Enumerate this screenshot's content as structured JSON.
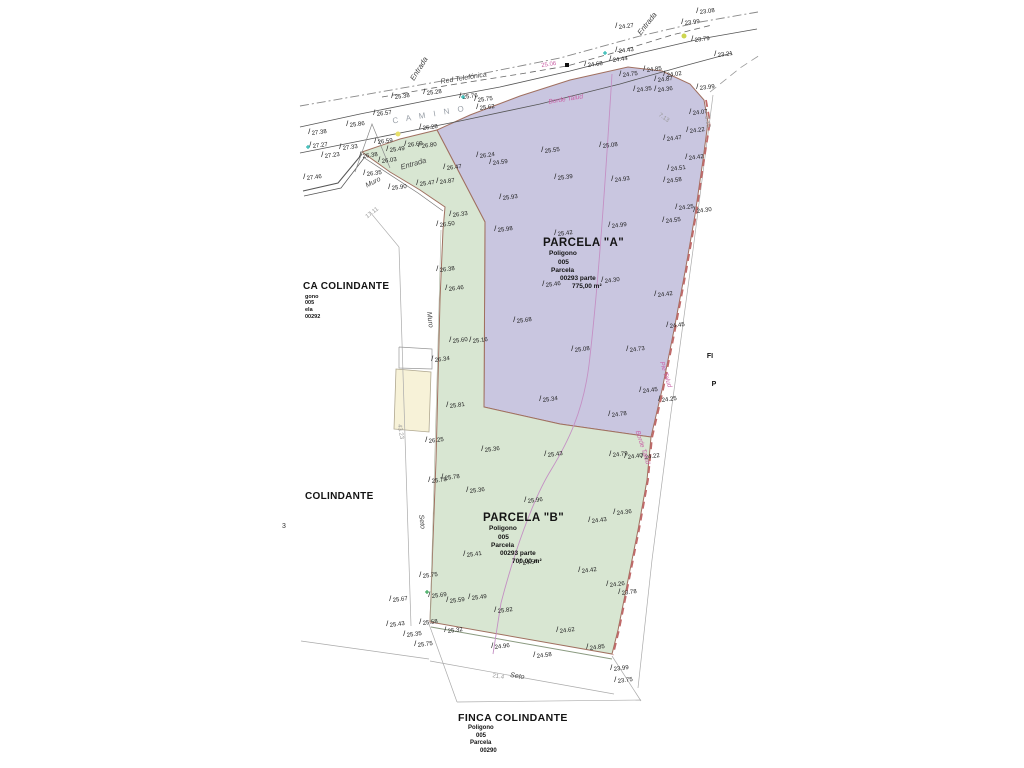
{
  "canvas": {
    "w": 1024,
    "h": 768,
    "bg": "#ffffff"
  },
  "colors": {
    "parcel_a_fill": "#c9c6e0",
    "parcel_b_fill": "#d8e6d2",
    "building_fill": "#f7f2d8",
    "parcel_stroke": "#a07060",
    "boundary_dash": "#c06a6a",
    "contour": "#c490c4",
    "pink_label": "#c95fa5",
    "dim_gray": "#aaaaaa",
    "road": "#555555"
  },
  "blocks": {
    "a": {
      "title": "PARCELA \"A\"",
      "lines": [
        "Poligono",
        "005",
        "Parcela",
        "00293 parte",
        "775,00 m²"
      ]
    },
    "b": {
      "title": "PARCELA \"B\"",
      "lines": [
        "Poligono",
        "005",
        "Parcela",
        "00293 parte",
        "700,00 m²"
      ]
    },
    "finca_bottom": {
      "title": "FINCA COLINDANTE",
      "lines": [
        "Poligono",
        "005",
        "Parcela",
        "00290"
      ]
    },
    "finca_left": {
      "title": "CA COLINDANTE",
      "lines": [
        "gono",
        "005",
        "ela",
        "00292"
      ]
    },
    "colindante": {
      "title": "COLINDANTE"
    }
  },
  "misc": {
    "left_digit": "3"
  },
  "parcels": [
    {
      "id": "parcel-a",
      "fill": "#c9c6e0",
      "stroke": "#a07060",
      "w": 1,
      "points": [
        [
          437,
          130
        ],
        [
          470,
          115
        ],
        [
          520,
          96
        ],
        [
          570,
          80
        ],
        [
          628,
          67
        ],
        [
          662,
          71
        ],
        [
          690,
          84
        ],
        [
          704,
          100
        ],
        [
          708,
          122
        ],
        [
          703,
          160
        ],
        [
          695,
          215
        ],
        [
          685,
          272
        ],
        [
          674,
          330
        ],
        [
          662,
          390
        ],
        [
          651,
          437
        ],
        [
          560,
          424
        ],
        [
          484,
          407
        ],
        [
          485,
          222
        ]
      ]
    },
    {
      "id": "parcel-b",
      "fill": "#d8e6d2",
      "stroke": "#a07060",
      "w": 1,
      "points": [
        [
          362,
          152
        ],
        [
          400,
          139
        ],
        [
          437,
          130
        ],
        [
          485,
          222
        ],
        [
          484,
          407
        ],
        [
          560,
          424
        ],
        [
          651,
          437
        ],
        [
          647,
          480
        ],
        [
          638,
          530
        ],
        [
          628,
          580
        ],
        [
          618,
          630
        ],
        [
          612,
          654
        ],
        [
          430,
          622
        ],
        [
          433,
          540
        ],
        [
          436,
          460
        ],
        [
          438,
          380
        ],
        [
          440,
          300
        ],
        [
          443,
          230
        ],
        [
          445,
          207
        ],
        [
          420,
          190
        ],
        [
          390,
          172
        ]
      ]
    },
    {
      "id": "building",
      "fill": "#f7f2d8",
      "stroke": "#b0a890",
      "w": 0.8,
      "points": [
        [
          396,
          369
        ],
        [
          431,
          372
        ],
        [
          429,
          432
        ],
        [
          394,
          429
        ]
      ]
    }
  ],
  "lines": [
    {
      "p": [
        [
          300,
          106
        ],
        [
          380,
          92
        ],
        [
          470,
          76
        ],
        [
          560,
          58
        ],
        [
          640,
          36
        ],
        [
          700,
          22
        ],
        [
          758,
          12
        ]
      ],
      "c": "#888",
      "w": 0.9,
      "d": "9 3 2 3"
    },
    {
      "p": [
        [
          382,
          97
        ],
        [
          450,
          85
        ],
        [
          520,
          74
        ],
        [
          567,
          66
        ],
        [
          620,
          51
        ],
        [
          672,
          35
        ],
        [
          712,
          25
        ]
      ],
      "c": "#666",
      "w": 0.8,
      "d": "6 4"
    },
    {
      "p": [
        [
          300,
          127
        ],
        [
          360,
          114
        ],
        [
          430,
          100
        ],
        [
          500,
          87
        ],
        [
          570,
          71
        ],
        [
          640,
          53
        ],
        [
          700,
          39
        ],
        [
          757,
          29
        ]
      ],
      "c": "#555",
      "w": 0.8
    },
    {
      "p": [
        [
          300,
          153
        ],
        [
          380,
          137
        ],
        [
          460,
          121
        ],
        [
          540,
          104
        ],
        [
          620,
          84
        ],
        [
          680,
          67
        ],
        [
          732,
          53
        ]
      ],
      "c": "#555",
      "w": 0.8
    },
    {
      "p": [
        [
          303,
          191
        ],
        [
          338,
          183
        ],
        [
          362,
          154
        ]
      ],
      "c": "#555",
      "w": 1
    },
    {
      "p": [
        [
          304,
          196
        ],
        [
          341,
          188
        ],
        [
          364,
          158
        ]
      ],
      "c": "#555",
      "w": 0.7
    },
    {
      "p": [
        [
          355,
          172
        ],
        [
          372,
          124
        ],
        [
          390,
          168
        ]
      ],
      "c": "#888",
      "w": 0.7
    },
    {
      "p": [
        [
          363,
          157
        ],
        [
          418,
          193
        ],
        [
          443,
          211
        ]
      ],
      "c": "#777",
      "w": 0.7
    },
    {
      "p": [
        [
          441,
          230
        ],
        [
          437,
          380
        ],
        [
          433,
          520
        ],
        [
          430,
          620
        ]
      ],
      "c": "#aab5a0",
      "w": 0.6
    },
    {
      "p": [
        [
          399,
          247
        ],
        [
          411,
          626
        ]
      ],
      "c": "#aaa",
      "w": 0.7
    },
    {
      "p": [
        [
          399,
          247
        ],
        [
          370,
          212
        ]
      ],
      "c": "#aaa",
      "w": 0.6
    },
    {
      "p": [
        [
          301,
          641
        ],
        [
          429,
          659
        ]
      ],
      "c": "#aaa",
      "w": 0.7
    },
    {
      "p": [
        [
          430,
          661
        ],
        [
          614,
          694
        ]
      ],
      "c": "#aaa",
      "w": 0.7
    },
    {
      "p": [
        [
          429,
          624
        ],
        [
          457,
          702
        ]
      ],
      "c": "#aaa",
      "w": 0.7
    },
    {
      "p": [
        [
          612,
          656
        ],
        [
          641,
          701
        ]
      ],
      "c": "#aaa",
      "w": 0.7
    },
    {
      "p": [
        [
          457,
          702
        ],
        [
          641,
          700
        ]
      ],
      "c": "#aaa",
      "w": 0.7
    },
    {
      "p": [
        [
          713,
          95
        ],
        [
          693,
          250
        ],
        [
          670,
          420
        ],
        [
          652,
          560
        ],
        [
          638,
          688
        ]
      ],
      "c": "#aaa",
      "w": 0.7
    },
    {
      "p": [
        [
          706,
          100
        ],
        [
          710,
          122
        ],
        [
          704,
          160
        ],
        [
          696,
          215
        ],
        [
          686,
          272
        ],
        [
          675,
          330
        ],
        [
          663,
          390
        ],
        [
          652,
          438
        ],
        [
          648,
          480
        ],
        [
          639,
          530
        ],
        [
          629,
          580
        ],
        [
          619,
          630
        ],
        [
          613,
          655
        ]
      ],
      "c": "#c06a6a",
      "w": 1.8,
      "d": "7 5"
    },
    {
      "p": [
        [
          710,
          92
        ],
        [
          740,
          68
        ],
        [
          760,
          55
        ]
      ],
      "c": "#999",
      "w": 0.8,
      "d": "8 5"
    },
    {
      "p": [
        [
          399,
          347
        ],
        [
          432,
          349
        ],
        [
          432,
          369
        ],
        [
          399,
          368
        ],
        [
          399,
          347
        ]
      ],
      "c": "#999",
      "w": 0.7
    },
    {
      "p": [
        [
          431,
          627
        ],
        [
          612,
          659
        ]
      ],
      "c": "#8a9a80",
      "w": 1
    }
  ],
  "curves": [
    {
      "d": "M612,74 C606,170 599,280 589,365 C583,412 568,442 551,470 C533,499 514,553 501,603 L493,654",
      "c": "#c490c4",
      "w": 0.9
    }
  ],
  "rotated_labels": [
    {
      "t": "Entrada",
      "x": 421,
      "y": 70,
      "r": -58,
      "s": 7.5,
      "i": 1
    },
    {
      "t": "Entrada",
      "x": 649,
      "y": 25,
      "r": -52,
      "s": 7.5,
      "i": 1
    },
    {
      "t": "Entrada",
      "x": 414,
      "y": 166,
      "r": -16,
      "s": 7.5,
      "i": 1
    },
    {
      "t": "Red Telefónica",
      "x": 464,
      "y": 80,
      "r": -9,
      "s": 7,
      "i": 1
    },
    {
      "t": "C A M I N O",
      "x": 430,
      "y": 117,
      "r": -10,
      "s": 8,
      "c": "#9aa0a8",
      "sp": 3
    },
    {
      "t": "Muro",
      "x": 374,
      "y": 184,
      "r": -27,
      "s": 7,
      "i": 1
    },
    {
      "t": "Muro",
      "x": 428,
      "y": 320,
      "r": 83,
      "s": 7,
      "i": 1
    },
    {
      "t": "Seto",
      "x": 420,
      "y": 522,
      "r": 83,
      "s": 7,
      "i": 1
    },
    {
      "t": "Seto",
      "x": 517,
      "y": 678,
      "r": 9,
      "s": 7,
      "i": 1
    },
    {
      "t": "17.11",
      "x": 373,
      "y": 214,
      "r": -38,
      "s": 6,
      "c": "#999"
    },
    {
      "t": "43.23",
      "x": 399,
      "y": 432,
      "r": 80,
      "s": 6,
      "c": "#999"
    },
    {
      "t": "7.13",
      "x": 663,
      "y": 119,
      "r": 35,
      "s": 6,
      "c": "#999"
    },
    {
      "t": "3.18",
      "x": 706,
      "y": 122,
      "r": 80,
      "s": 6,
      "c": "#999"
    },
    {
      "t": "21.4",
      "x": 498,
      "y": 678,
      "r": 9,
      "s": 6,
      "c": "#999"
    },
    {
      "t": "25.06",
      "x": 549,
      "y": 66,
      "r": -9,
      "s": 6,
      "c": "#c95fa5"
    },
    {
      "t": "Borde Talud",
      "x": 566,
      "y": 101,
      "r": -9,
      "s": 6.5,
      "c": "#c95fa5",
      "i": 1
    },
    {
      "t": "Pie Talud",
      "x": 664,
      "y": 375,
      "r": 72,
      "s": 6.5,
      "c": "#c95fa5",
      "i": 1
    },
    {
      "t": "Borde Talud",
      "x": 641,
      "y": 448,
      "r": 72,
      "s": 6.5,
      "c": "#c95fa5",
      "i": 1
    },
    {
      "t": "FI",
      "x": 710,
      "y": 358,
      "r": 0,
      "s": 7,
      "b": 1,
      "c": "#111"
    },
    {
      "t": "P",
      "x": 714,
      "y": 386,
      "r": 0,
      "s": 7,
      "b": 1,
      "c": "#111"
    }
  ],
  "elevations": [
    [
      "27.38",
      312,
      135
    ],
    [
      "27.27",
      313,
      148
    ],
    [
      "27.23",
      325,
      158
    ],
    [
      "27.46",
      307,
      180
    ],
    [
      "27.33",
      343,
      150
    ],
    [
      "26.35",
      367,
      176
    ],
    [
      "26.38",
      363,
      158
    ],
    [
      "26.59",
      378,
      144
    ],
    [
      "25.86",
      350,
      127
    ],
    [
      "26.57",
      377,
      116
    ],
    [
      "25.38",
      395,
      99
    ],
    [
      "25.28",
      427,
      95
    ],
    [
      "26.28",
      423,
      130
    ],
    [
      "25.76",
      463,
      99
    ],
    [
      "25.75",
      478,
      102
    ],
    [
      "25.62",
      480,
      110
    ],
    [
      "25.90",
      392,
      190
    ],
    [
      "26.69",
      408,
      147
    ],
    [
      "26.80",
      422,
      148
    ],
    [
      "25.49",
      390,
      152
    ],
    [
      "26.47",
      447,
      170
    ],
    [
      "26.03",
      382,
      163
    ],
    [
      "25.47",
      420,
      186
    ],
    [
      "24.87",
      440,
      184
    ],
    [
      "24.27",
      619,
      29
    ],
    [
      "23.99",
      685,
      25
    ],
    [
      "23.08",
      700,
      14
    ],
    [
      "23.79",
      695,
      42
    ],
    [
      "23.21",
      718,
      57
    ],
    [
      "24.43",
      619,
      53
    ],
    [
      "24.44",
      613,
      62
    ],
    [
      "24.68",
      588,
      67
    ],
    [
      "24.75",
      623,
      77
    ],
    [
      "24.85",
      647,
      72
    ],
    [
      "24.02",
      667,
      77
    ],
    [
      "24.87",
      658,
      82
    ],
    [
      "23.99",
      700,
      90
    ],
    [
      "24.35",
      637,
      92
    ],
    [
      "24.36",
      658,
      92
    ],
    [
      "24.07",
      693,
      115
    ],
    [
      "24.22",
      690,
      133
    ],
    [
      "24.47",
      667,
      141
    ],
    [
      "24.42",
      689,
      160
    ],
    [
      "24.51",
      671,
      171
    ],
    [
      "24.58",
      667,
      183
    ],
    [
      "24.25",
      679,
      210
    ],
    [
      "24.30",
      697,
      213
    ],
    [
      "24.55",
      666,
      223
    ],
    [
      "25.08",
      603,
      148
    ],
    [
      "25.55",
      545,
      153
    ],
    [
      "26.24",
      480,
      158
    ],
    [
      "24.59",
      493,
      165
    ],
    [
      "25.39",
      558,
      180
    ],
    [
      "24.93",
      615,
      182
    ],
    [
      "25.93",
      503,
      200
    ],
    [
      "25.98",
      498,
      232
    ],
    [
      "25.42",
      558,
      236
    ],
    [
      "24.99",
      612,
      228
    ],
    [
      "24.30",
      605,
      283
    ],
    [
      "25.46",
      546,
      287
    ],
    [
      "24.42",
      658,
      297
    ],
    [
      "25.68",
      517,
      323
    ],
    [
      "24.45",
      670,
      328
    ],
    [
      "25.08",
      575,
      352
    ],
    [
      "24.73",
      630,
      352
    ],
    [
      "24.45",
      643,
      393
    ],
    [
      "24.25",
      662,
      402
    ],
    [
      "24.78",
      612,
      417
    ],
    [
      "25.34",
      543,
      402
    ],
    [
      "25.81",
      450,
      408
    ],
    [
      "26.33",
      453,
      217
    ],
    [
      "26.50",
      440,
      227
    ],
    [
      "26.38",
      440,
      272
    ],
    [
      "26.46",
      449,
      291
    ],
    [
      "25.60",
      453,
      343
    ],
    [
      "25.16",
      473,
      343
    ],
    [
      "26.34",
      435,
      362
    ],
    [
      "26.25",
      429,
      443
    ],
    [
      "25.78",
      432,
      483
    ],
    [
      "25.36",
      485,
      452
    ],
    [
      "25.43",
      548,
      457
    ],
    [
      "25.78",
      445,
      480
    ],
    [
      "24.79",
      613,
      457
    ],
    [
      "24.40",
      628,
      459
    ],
    [
      "24.22",
      645,
      459
    ],
    [
      "25.36",
      470,
      493
    ],
    [
      "25.96",
      528,
      503
    ],
    [
      "24.36",
      617,
      515
    ],
    [
      "24.43",
      592,
      523
    ],
    [
      "25.41",
      467,
      557
    ],
    [
      "24.54",
      523,
      565
    ],
    [
      "24.42",
      582,
      573
    ],
    [
      "24.26",
      610,
      587
    ],
    [
      "23.78",
      622,
      595
    ],
    [
      "25.49",
      472,
      600
    ],
    [
      "25.69",
      432,
      598
    ],
    [
      "25.67",
      393,
      602
    ],
    [
      "25.75",
      423,
      578
    ],
    [
      "25.59",
      450,
      603
    ],
    [
      "25.82",
      498,
      613
    ],
    [
      "25.58",
      423,
      625
    ],
    [
      "25.43",
      390,
      627
    ],
    [
      "25.32",
      448,
      633
    ],
    [
      "24.62",
      560,
      633
    ],
    [
      "25.35",
      407,
      637
    ],
    [
      "25.75",
      418,
      647
    ],
    [
      "24.96",
      495,
      649
    ],
    [
      "24.58",
      537,
      658
    ],
    [
      "24.85",
      590,
      650
    ],
    [
      "23.99",
      614,
      671
    ],
    [
      "23.75",
      618,
      683
    ]
  ],
  "symbols": [
    {
      "k": "sq",
      "x": 567,
      "y": 65,
      "c": "#111111"
    },
    {
      "k": "dot",
      "x": 684,
      "y": 36,
      "c": "#cdd64f"
    },
    {
      "k": "dot",
      "x": 398,
      "y": 134,
      "c": "#e8e06a"
    },
    {
      "k": "tick",
      "x": 463,
      "y": 97,
      "c": "#29b6b0"
    },
    {
      "k": "tick",
      "x": 605,
      "y": 53,
      "c": "#29b6b0"
    },
    {
      "k": "tick",
      "x": 427,
      "y": 592,
      "c": "#3aa85a"
    },
    {
      "k": "tick",
      "x": 308,
      "y": 147,
      "c": "#29b6b0"
    }
  ]
}
